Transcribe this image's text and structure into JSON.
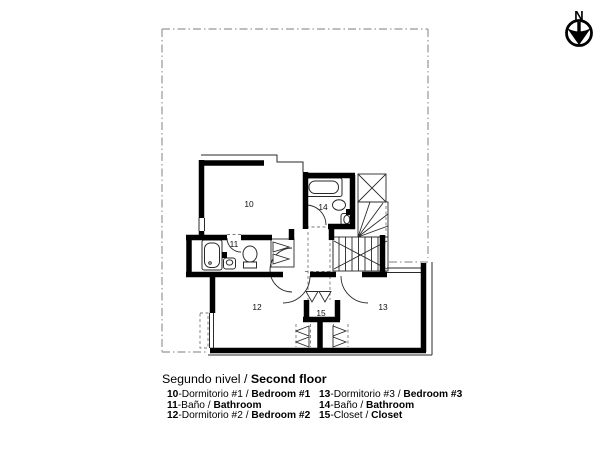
{
  "north_label": "N",
  "title": {
    "es": "Segundo nivel / ",
    "en": "Second floor"
  },
  "rooms": [
    {
      "label": "10"
    },
    {
      "label": "11"
    },
    {
      "label": "12"
    },
    {
      "label": "13"
    },
    {
      "label": "14"
    },
    {
      "label": "15"
    }
  ],
  "legend": {
    "col1": [
      {
        "num": "10",
        "es": "-Dormitorio #1 / ",
        "en": "Bedroom #1"
      },
      {
        "num": "11",
        "es": "-Baño / ",
        "en": "Bathroom"
      },
      {
        "num": "12",
        "es": "-Dormitorio #2 / ",
        "en": "Bedroom #2"
      }
    ],
    "col2": [
      {
        "num": "13",
        "es": "-Dormitorio #3 / ",
        "en": "Bedroom #3"
      },
      {
        "num": "14",
        "es": "-Baño / ",
        "en": "Bathroom"
      },
      {
        "num": "15",
        "es": "-Closet / ",
        "en": "Closet"
      }
    ]
  },
  "colors": {
    "wall": "#000000",
    "thin": "#2a2a2a",
    "boundary": "#979797",
    "dash": "#7a7a7a"
  }
}
